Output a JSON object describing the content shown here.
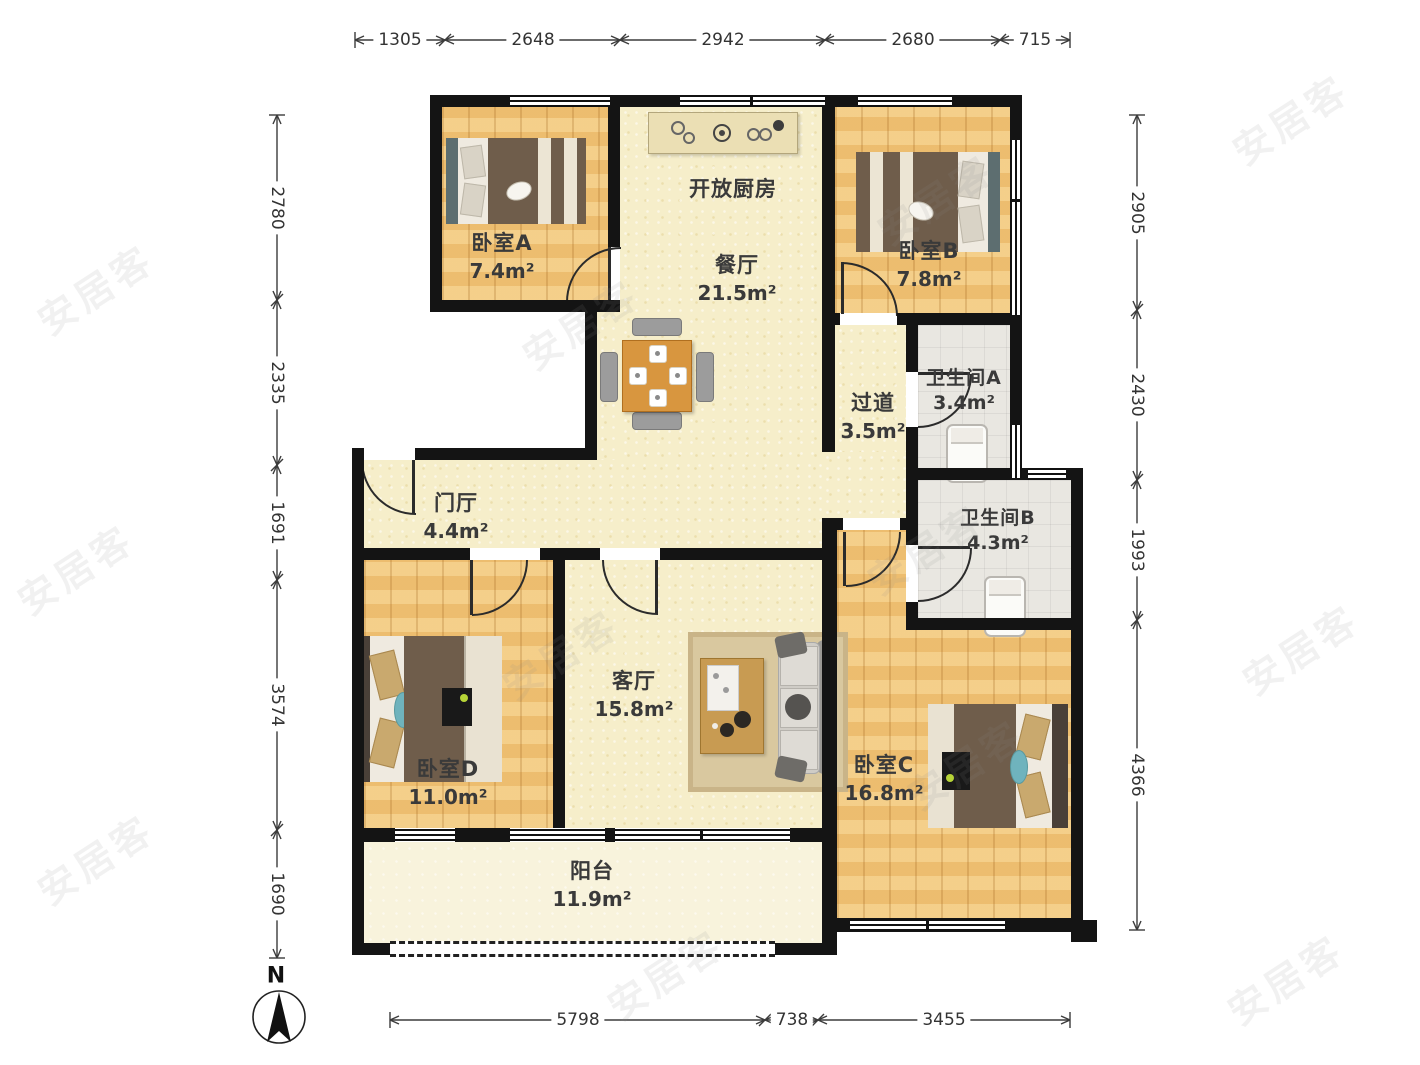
{
  "dimensions": {
    "top": [
      "1305",
      "2648",
      "2942",
      "2680",
      "715"
    ],
    "bottom": [
      "5798",
      "738",
      "3455"
    ],
    "left": [
      "2780",
      "2335",
      "1691",
      "3574",
      "1690"
    ],
    "right": [
      "2905",
      "2430",
      "1993",
      "4366"
    ]
  },
  "rooms": {
    "bedroomA": {
      "name": "卧室A",
      "area": "7.4m²"
    },
    "kitchen": {
      "name": "开放厨房"
    },
    "dining": {
      "name": "餐厅",
      "area": "21.5m²"
    },
    "bedroomB": {
      "name": "卧室B",
      "area": "7.8m²"
    },
    "corridor": {
      "name": "过道",
      "area": "3.5m²"
    },
    "bathroomA": {
      "name": "卫生间A",
      "area": "3.4m²"
    },
    "bathroomB": {
      "name": "卫生间B",
      "area": "4.3m²"
    },
    "hall": {
      "name": "门厅",
      "area": "4.4m²"
    },
    "bedroomD": {
      "name": "卧室D",
      "area": "11.0m²"
    },
    "living": {
      "name": "客厅",
      "area": "15.8m²"
    },
    "bedroomC": {
      "name": "卧室C",
      "area": "16.8m²"
    },
    "balcony": {
      "name": "阳台",
      "area": "11.9m²"
    }
  },
  "compass": {
    "label": "N"
  },
  "watermark": {
    "text": "安居客"
  },
  "colors": {
    "wall": "#141414",
    "wood_floor": "#efc276",
    "cream_floor": "#f6eeca",
    "tile_floor": "#e9e7e1",
    "table": "#d8963f",
    "bed_blanket": "#6f5d4b"
  }
}
